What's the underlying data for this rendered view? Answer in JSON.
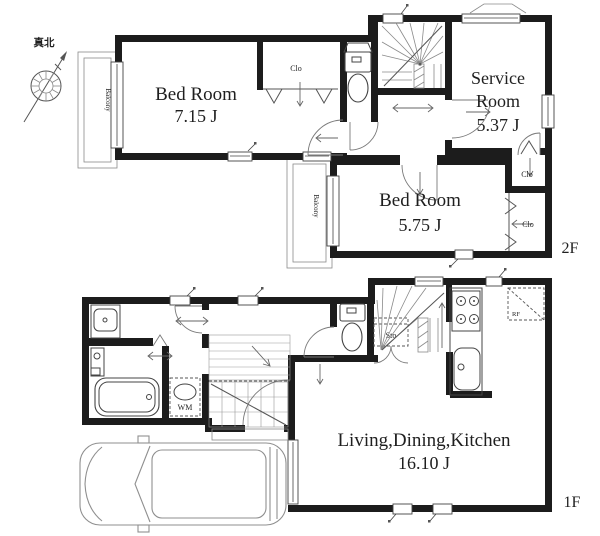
{
  "compass": {
    "north_label": "真北"
  },
  "floor_2f": {
    "floor_label": "2F",
    "bedroom_1": {
      "name": "Bed Room",
      "area": "7.15 J"
    },
    "bedroom_1_closet": {
      "label": "Clo"
    },
    "service_room": {
      "name_line_1": "Service",
      "name_line_2": "Room",
      "area": "5.37 J"
    },
    "bedroom_2": {
      "name": "Bed Room",
      "area": "5.75 J"
    },
    "closet_upper_right": {
      "label": "Clo"
    },
    "closet_lower_right": {
      "label": "Clo"
    },
    "balcony_west": {
      "label": "Balcony"
    },
    "balcony_center": {
      "label": "Balcony"
    }
  },
  "floor_1f": {
    "floor_label": "1F",
    "living_dining_kitchen": {
      "name": "Living,Dining,Kitchen",
      "area": "16.10 J"
    },
    "washing_machine": {
      "label": "WM"
    },
    "under_stair_storage": {
      "label": "Sto"
    },
    "refrigerator": {
      "label": "RF"
    }
  }
}
